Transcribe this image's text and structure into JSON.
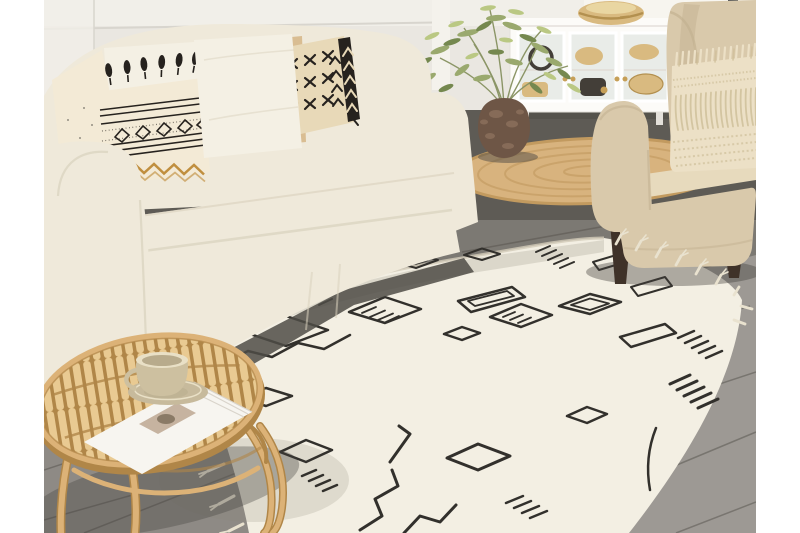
{
  "photo": {
    "description": "Bright boho living room: white slipcovered sofa with patterned cushions, beige wingback armchair with a fringed pillow, white glass-door sideboard with wicker baskets, potted green plant in a rustic pot, round jute rug, cream berber-style rug with black geometric pattern and tassels, and a round rattan coffee table holding a magazine and a beige teacup, all on grey wood flooring."
  },
  "scene": {
    "objects": [
      {
        "id": "sofa",
        "label": "White slipcovered sofa"
      },
      {
        "id": "cushion-plain",
        "label": "Cream scatter cushion"
      },
      {
        "id": "cushion-tassel",
        "label": "Tasselled berber cushion"
      },
      {
        "id": "cushion-white",
        "label": "White square cushion"
      },
      {
        "id": "cushion-woven",
        "label": "Beige woven cushion"
      },
      {
        "id": "cushion-mudcloth",
        "label": "Black and white mudcloth cushion"
      },
      {
        "id": "armchair",
        "label": "Beige wingback armchair"
      },
      {
        "id": "fringe-pillow",
        "label": "Cream fringed pillow"
      },
      {
        "id": "sideboard",
        "label": "White glass-door sideboard"
      },
      {
        "id": "basket-bowl",
        "label": "Wicker basket bowl"
      },
      {
        "id": "plant",
        "label": "Green potted plant"
      },
      {
        "id": "plant-pot",
        "label": "Rustic brown plant pot"
      },
      {
        "id": "jute-rug",
        "label": "Round jute rug"
      },
      {
        "id": "berber-rug",
        "label": "Cream berber rug with black geometric pattern"
      },
      {
        "id": "coffee-table",
        "label": "Round rattan coffee table"
      },
      {
        "id": "magazine",
        "label": "Magazine"
      },
      {
        "id": "teacup",
        "label": "Beige teacup and saucer"
      },
      {
        "id": "floor",
        "label": "Grey wood floor"
      },
      {
        "id": "wall",
        "label": "Light panelled wall"
      }
    ]
  },
  "colors": {
    "letterbox": "#ffffff",
    "wall": "#eae7e1",
    "wall_top": "#f1efe9",
    "wall_line": "#d8d5ce",
    "window_light": "#f7f5ef",
    "window_frame": "#3d4248",
    "floor_dark": "#5e5b55",
    "floor_mid": "#7c7973",
    "floor_light": "#9d9994",
    "floor_seam": "#55524c",
    "cabinet": "#fcfbf8",
    "cabinet_shadow": "#e3e0da",
    "glass": "#e9ece8",
    "knob": "#c69f57",
    "basket": "#d9ba80",
    "basket_dark": "#b3904f",
    "basket_light": "#e9d6a2",
    "dark_decor": "#433e38",
    "plant_leaf": "#9aa96e",
    "plant_leaf_dark": "#75884f",
    "plant_leaf_light": "#bac883",
    "plant_stem": "#8b9566",
    "pot": "#6e5646",
    "pot_light": "#967a64",
    "jute": "#d8b37e",
    "jute_dark": "#c29a5f",
    "sofa": "#efe9da",
    "sofa_shade": "#d9d1bd",
    "shadow_dark": "#4f4c46",
    "pillow_white": "#f4f0e4",
    "pillow_cream": "#f3ead6",
    "pillow_tan": "#d9bd92",
    "pillow_tan_line": "#c19e6e",
    "pillow_tan_dot": "#ecdcbb",
    "pillow_mud": "#e8d9b8",
    "pattern_black": "#26221e",
    "zigzag_tan": "#c08f3f",
    "chair": "#d9c9ab",
    "chair_shade": "#c3b292",
    "chair_seat": "#e7dabd",
    "leg_wood": "#3f3229",
    "fringe_pillow": "#ece0c6",
    "fringe_shadow": "#cfbf9a",
    "rug_base": "#f3efe3",
    "rug_shade": "#d2cbb8",
    "rug_pattern": "#32302c",
    "rug_tassel": "#e9e2cf",
    "rattan": "#dcb277",
    "rattan_light": "#e9ca92",
    "rattan_dark": "#b08648",
    "magazine": "#f7f5f0",
    "magazine_edge": "#d9d4cb",
    "magazine_photo": "#c6b3a0",
    "cup": "#cdc0a0",
    "cup_rim": "#e9e0c6",
    "cup_inner": "#b8ab8c",
    "saucer": "#c7ba9c"
  }
}
